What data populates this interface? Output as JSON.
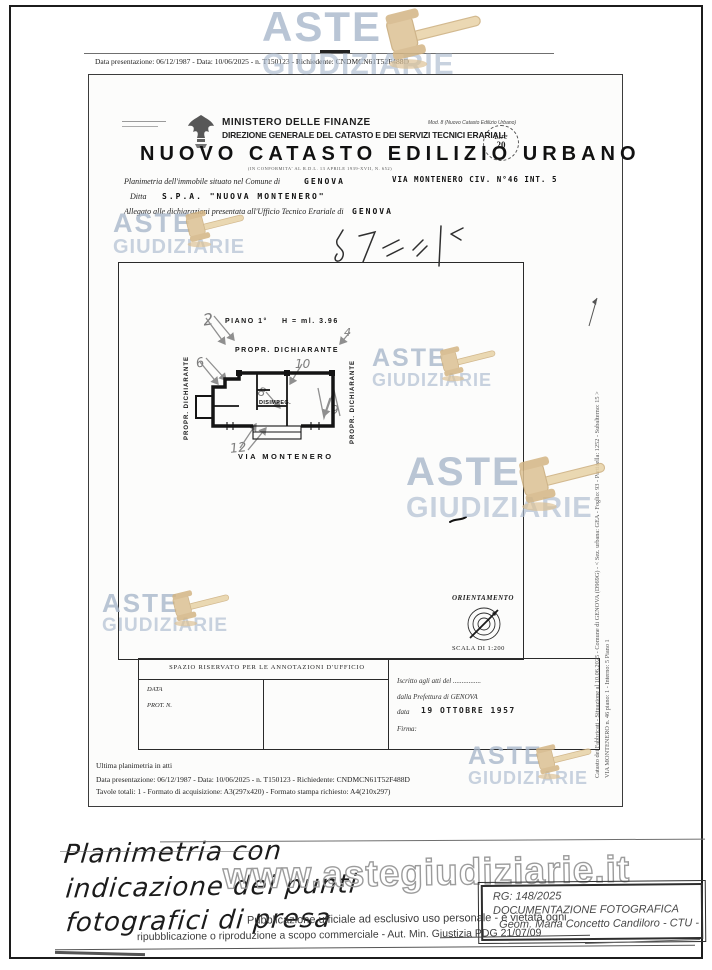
{
  "page": {
    "top_line": "Data presentazione: 06/12/1987 - Data: 10/06/2025 - n. T150123 - Richiedente: CNDMCN61T52F488D"
  },
  "header": {
    "ministry": "MINISTERO DELLE FINANZE",
    "direzione": "DIREZIONE GENERALE DEL CATASTO E DEI SERVIZI TECNICI ERARIALI",
    "title": "NUOVO CATASTO EDILIZIO URBANO",
    "subtitle": "(IN CONFORMITA' AL R.D.L. 13 APRILE 1939-XVII, N. 652)",
    "mod_note": "Mod. 8 (Nuovo Catasto Edilizio Urbano)",
    "lire_label": "Lire",
    "lire_value": "20"
  },
  "form": {
    "line1_label": "Planimetria dell'immobile situato nel Comune di",
    "line1_value": "GENOVA",
    "line1_right": "VIA MONTENERO CIV. N°46 INT. 5",
    "line2_label": "Ditta",
    "line2_value": "S.P.A.  \"NUOVA MONTENERO\"",
    "line3_label": "Allegato alle dichiarazioni presentata all'Ufficio Tecnico Erariale di",
    "line3_value": "GENOVA"
  },
  "plan": {
    "floor_label": "PIANO 1°",
    "height_label": "H = ml. 3.96",
    "top_owner": "PROPR. DICHIARANTE",
    "left_owner": "PROPR. DICHIARANTE",
    "right_owner": "PROPR. DICHIARANTE",
    "street": "VIA MONTENERO",
    "room_label": "DISIMPEG.",
    "photo_points": [
      "2",
      "4",
      "6",
      "8",
      "9",
      "10",
      "12"
    ],
    "orientation_title": "ORIENTAMENTO",
    "orientation_scale": "SCALA DI 1:200"
  },
  "annotations": {
    "title": "SPAZIO RISERVATO PER LE ANNOTAZIONI D'UFFICIO",
    "data_label": "DATA",
    "prot_label": "PROT. N.",
    "right_line1": "Iscritto agli atti del ................",
    "right_line2": "dalla Prefettura di GENOVA",
    "date_label": "data",
    "date_value": "19 OTTOBRE 1957",
    "sign_label": "Firma:"
  },
  "sheet_footer": {
    "line0": "Ultima planimetria in atti",
    "line1": "Data presentazione: 06/12/1987 - Data: 10/06/2025 - n. T150123 - Richiedente: CNDMCN61T52F488D",
    "line2": "Tavole totali: 1 - Formato di acquisizione: A3(297x420) - Formato stampa richiesto: A4(210x297)"
  },
  "side": {
    "line1": "Catasto dei Fabbricati - Situazione al 10.06.2025 - Comune di GENOVA (D969G) - < Sez. urbana: GEA - Foglio: 93 - Particella: 1252 - Subalterno: 15 >",
    "line2": "VIA MONTENERO n. 46 piano: 1 - Interno: 5  Piano 1"
  },
  "watermarks": {
    "aste": "ASTE",
    "giudiziarie": "GIUDIZIARIE",
    "url": "www.astegiudiziarie.it"
  },
  "bottom": {
    "caption1": "Planimetria con",
    "caption2": "indicazione dei punti",
    "caption3": "fotografici di presa",
    "disclaimer1": "Pubblicazione ufficiale ad esclusivo uso personale - è vietata ogni",
    "disclaimer2": "ripubblicazione o riproduzione a scopo commerciale - Aut. Min. Giustizia PDG 21/07/09",
    "box_rg": "RG: 148/2025",
    "box_doc": "DOCUMENTAZIONE FOTOGRAFICA",
    "box_ctu": "Geom. Maria Concetto Candiloro - CTU -"
  },
  "colors": {
    "watermark_text": "#aebdd0",
    "gavel": "#dcc193",
    "pencil": "#8a8a8a",
    "ink": "#1e1e1e"
  }
}
